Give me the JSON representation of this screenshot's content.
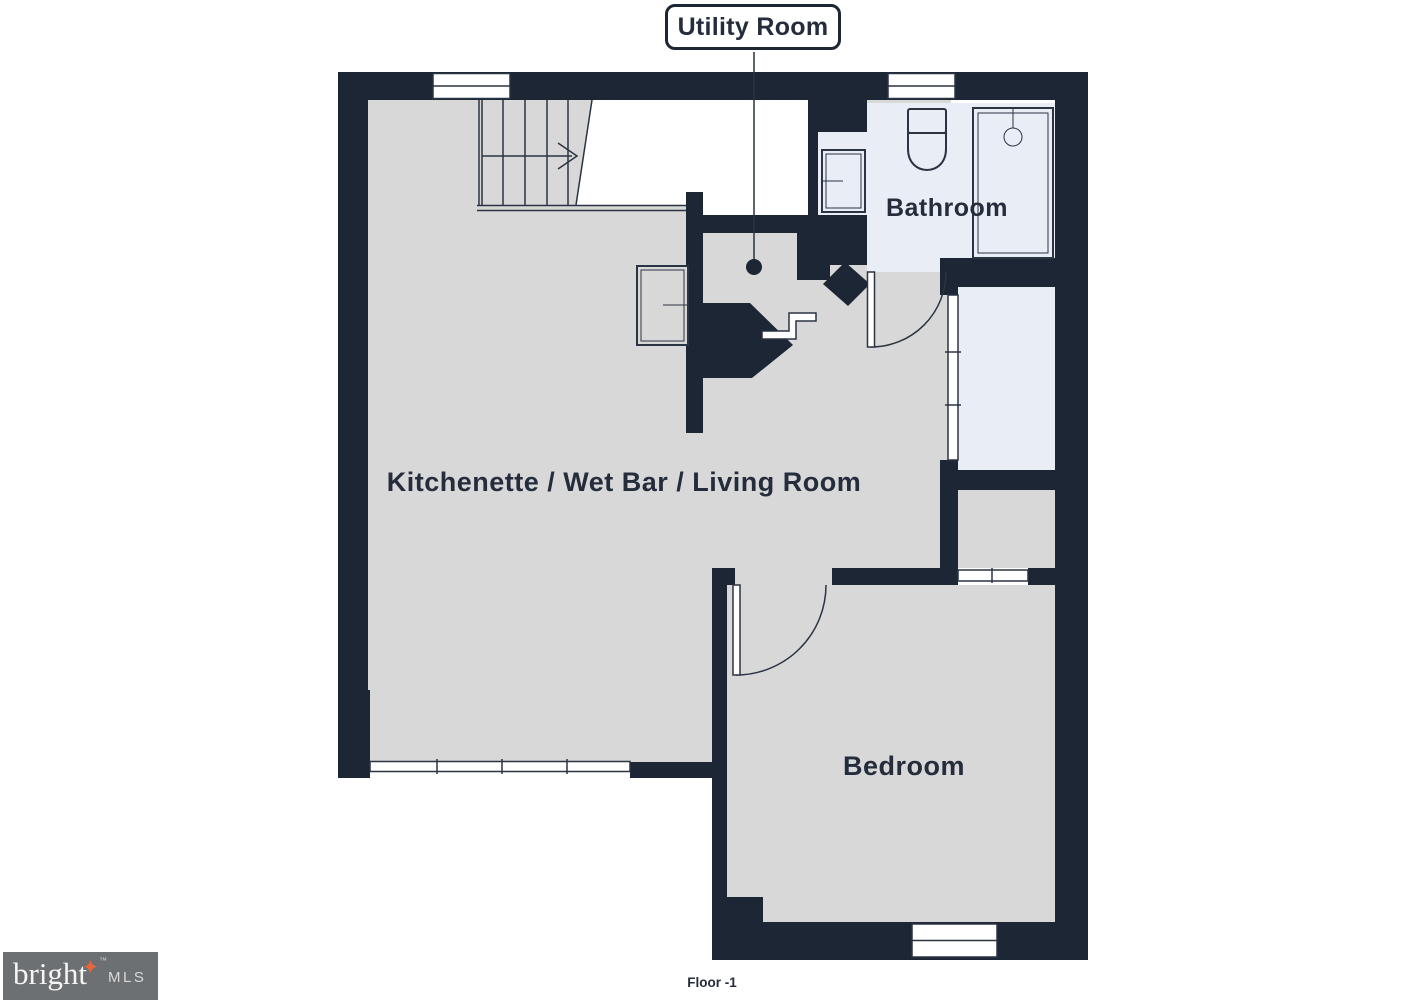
{
  "plan": {
    "callout_label": "Utility Room",
    "rooms": {
      "bathroom": "Bathroom",
      "living": "Kitchenette / Wet Bar / Living Room",
      "bedroom": "Bedroom"
    },
    "floor_label": "Floor -1"
  },
  "logo": {
    "brand": "bright",
    "suffix": "MLS",
    "tm": "™"
  },
  "colors": {
    "wall": "#1d2634",
    "line": "#2b3442",
    "floor_gray": "#d8d8d8",
    "floor_light": "#e9edf5",
    "text": "#252d3d",
    "logo_bg": "#6d7072",
    "logo_star": "#e8673a"
  }
}
